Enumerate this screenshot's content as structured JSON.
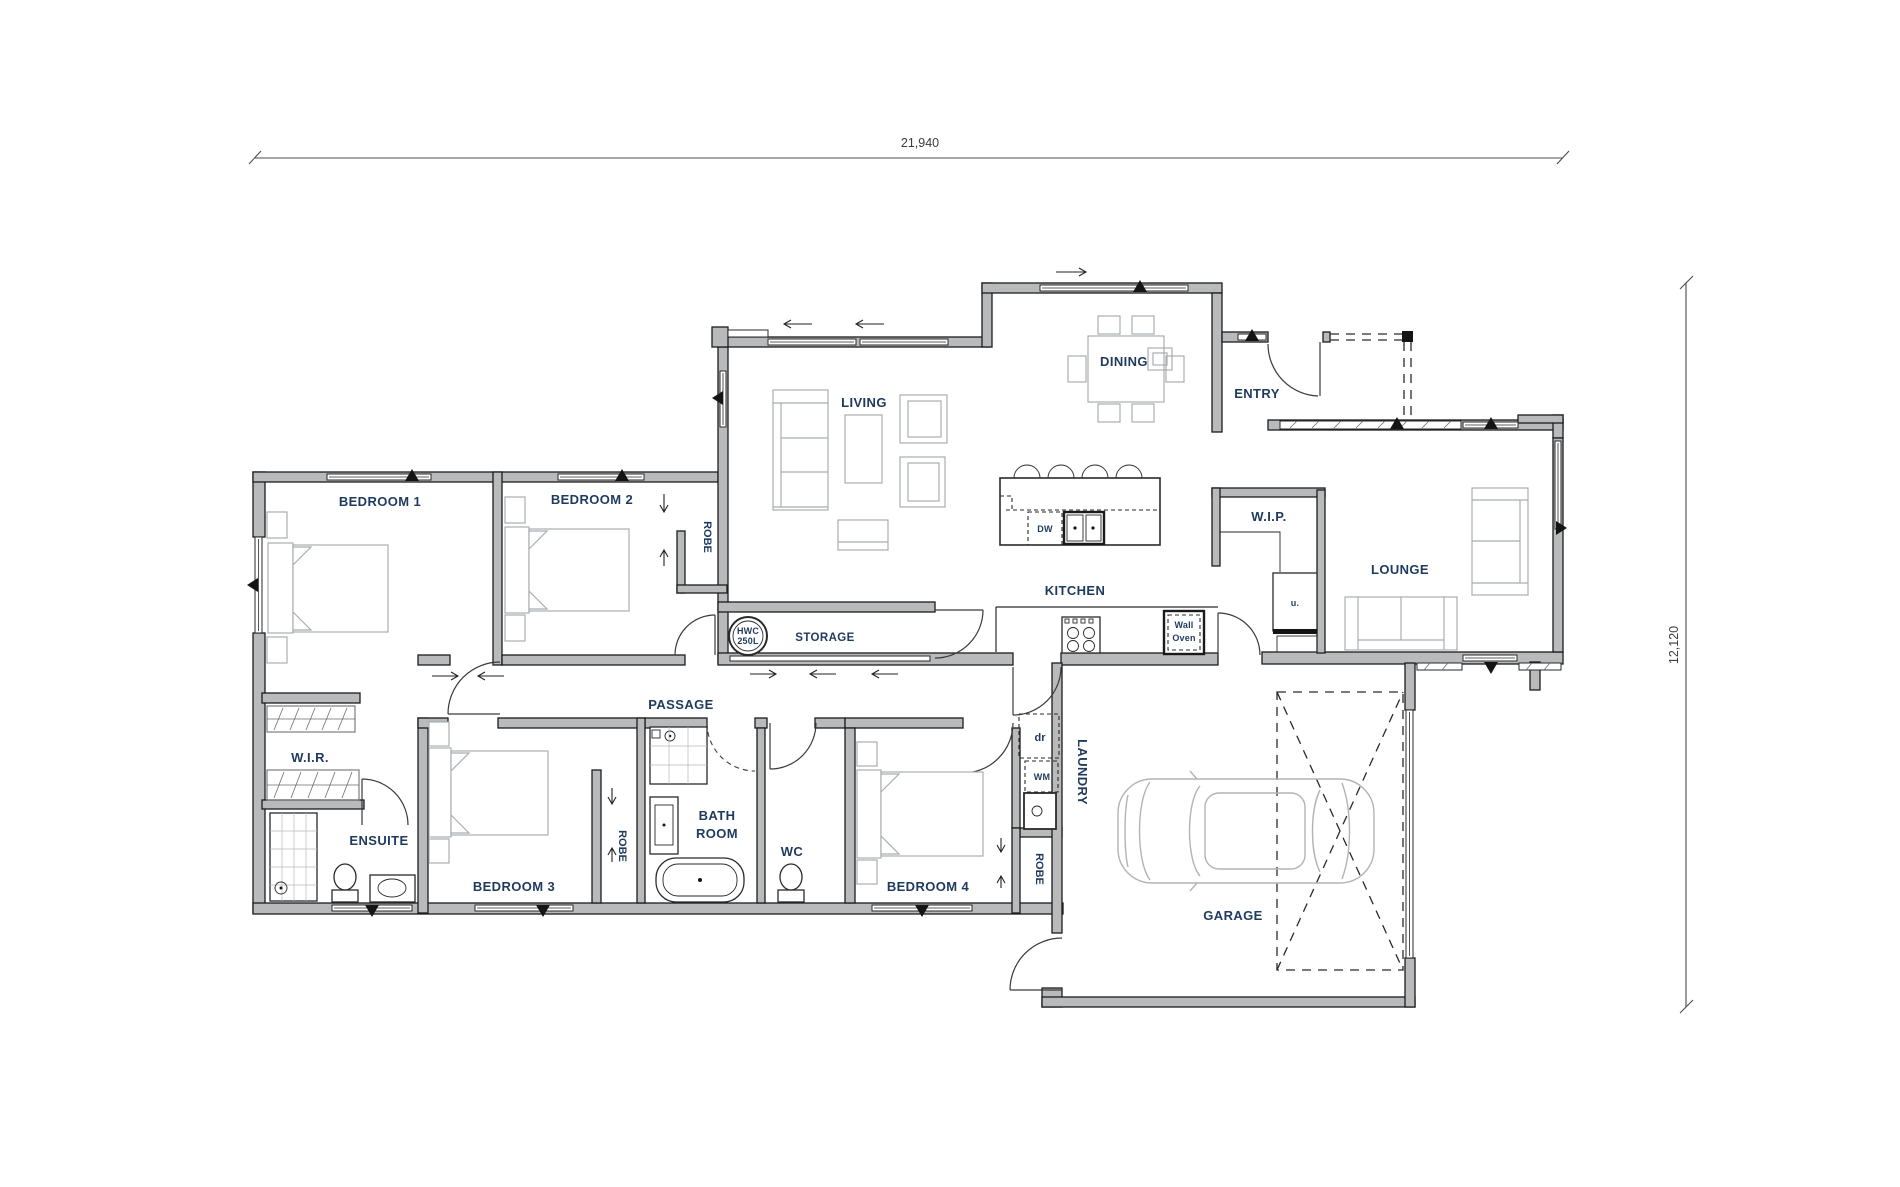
{
  "plan": {
    "title": "floor-plan",
    "dimensions": {
      "width_label": "21,940",
      "height_label": "12,120"
    },
    "rooms": {
      "bedroom1": "BEDROOM 1",
      "bedroom2": "BEDROOM 2",
      "bedroom3": "BEDROOM 3",
      "bedroom4": "BEDROOM 4",
      "wir": "W.I.R.",
      "ensuite": "ENSUITE",
      "bath_line1": "BATH",
      "bath_line2": "ROOM",
      "wc": "WC",
      "passage": "PASSAGE",
      "storage": "STORAGE",
      "living": "LIVING",
      "dining": "DINING",
      "entry": "ENTRY",
      "kitchen": "KITCHEN",
      "wip": "W.I.P.",
      "lounge": "LOUNGE",
      "laundry": "LAUNDRY",
      "garage": "GARAGE",
      "robe": "ROBE"
    },
    "fixtures": {
      "hwc_line1": "HWC",
      "hwc_line2": "250L",
      "dishwasher": "DW",
      "wall_oven_line1": "Wall",
      "wall_oven_line2": "Oven",
      "dryer": "dr",
      "washer": "WM",
      "fridge": "u."
    },
    "colors": {
      "wall_fill": "#b8babc",
      "wall_line": "#1c1c1c",
      "label": "#1f3a5f",
      "furniture_line": "#a9adb0"
    }
  }
}
